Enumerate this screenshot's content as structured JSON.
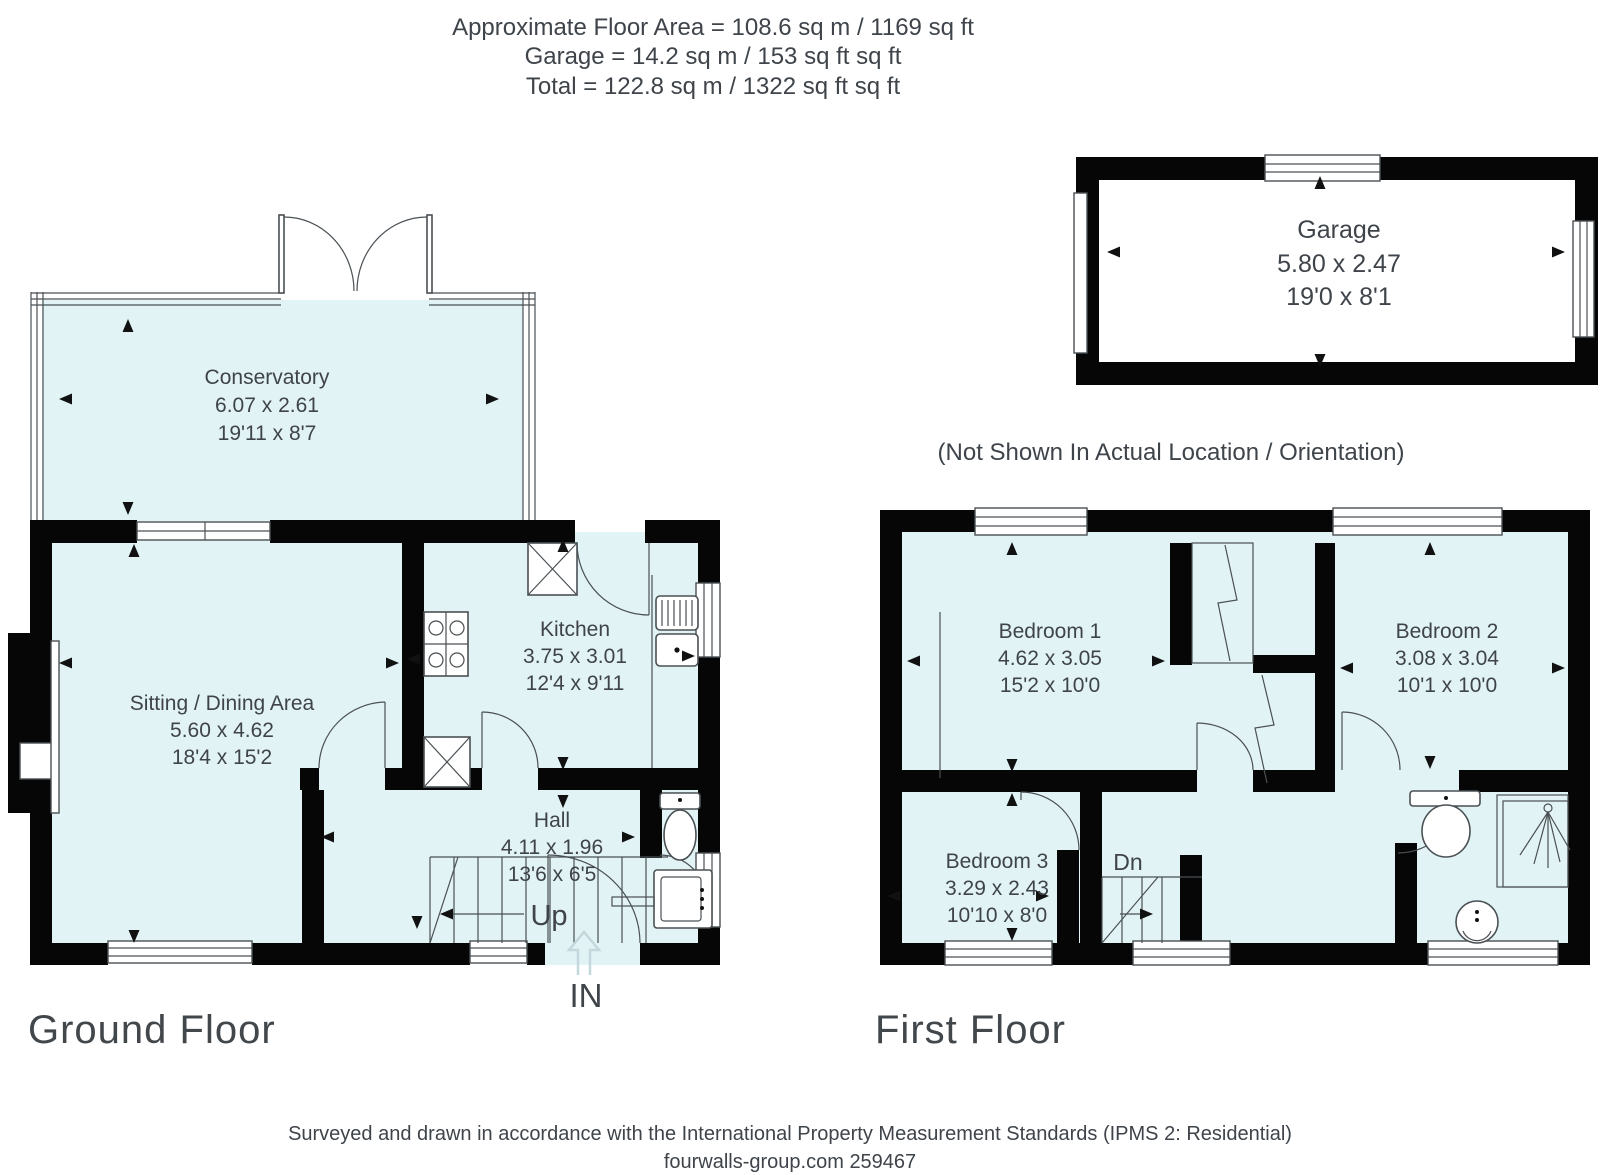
{
  "header": {
    "line1": "Approximate Floor Area = 108.6 sq m / 1169 sq ft",
    "line2": "Garage = 14.2 sq m / 153 sq ft sq ft",
    "line3": "Total = 122.8 sq m / 1322 sq ft sq ft"
  },
  "note": "(Not Shown In Actual Location / Orientation)",
  "garage": {
    "name": "Garage",
    "metric": "5.80 x 2.47",
    "imperial": "19'0 x 8'1"
  },
  "ground_floor": {
    "label": "Ground Floor",
    "rooms": {
      "conservatory": {
        "name": "Conservatory",
        "metric": "6.07 x 2.61",
        "imperial": "19'11 x 8'7"
      },
      "sitting": {
        "name": "Sitting / Dining Area",
        "metric": "5.60 x 4.62",
        "imperial": "18'4 x 15'2"
      },
      "kitchen": {
        "name": "Kitchen",
        "metric": "3.75 x 3.01",
        "imperial": "12'4 x 9'11"
      },
      "hall": {
        "name": "Hall",
        "metric": "4.11 x 1.96",
        "imperial": "13'6 x 6'5"
      }
    },
    "stairs_label": "Up",
    "entrance_label": "IN"
  },
  "first_floor": {
    "label": "First Floor",
    "rooms": {
      "bedroom1": {
        "name": "Bedroom 1",
        "metric": "4.62 x 3.05",
        "imperial": "15'2 x 10'0"
      },
      "bedroom2": {
        "name": "Bedroom 2",
        "metric": "3.08 x 3.04",
        "imperial": "10'1 x 10'0"
      },
      "bedroom3": {
        "name": "Bedroom 3",
        "metric": "3.29 x 2.43",
        "imperial": "10'10 x 8'0"
      }
    },
    "stairs_label": "Dn"
  },
  "footer": {
    "line1": "Surveyed and drawn in accordance with the International Property Measurement Standards (IPMS 2: Residential)",
    "line2": "fourwalls-group.com 259467"
  },
  "colors": {
    "room_fill": "#e2f3f6",
    "wall": "#060606",
    "line": "#4a5054",
    "text": "#3e444a",
    "entry_arrow": "#c3d8dc"
  }
}
